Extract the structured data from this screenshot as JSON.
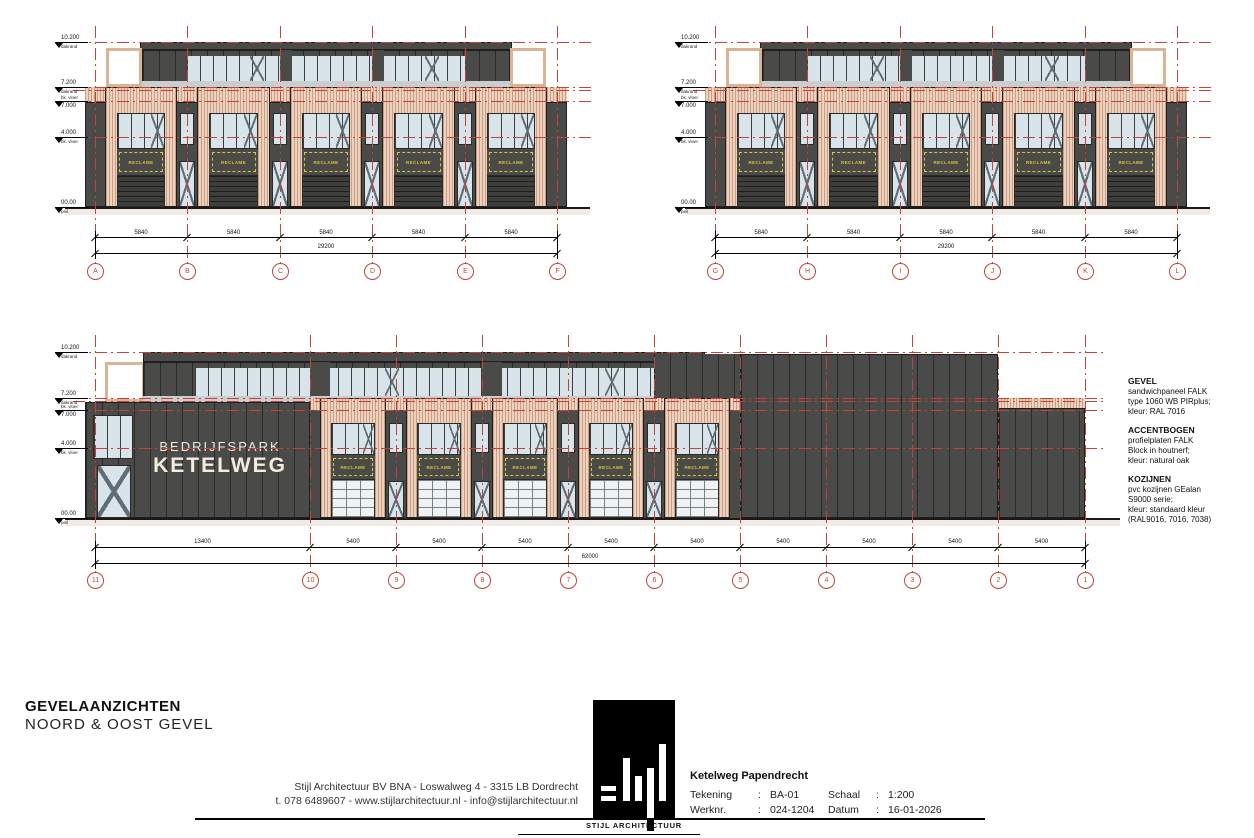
{
  "reclame_label": "RECLAME",
  "levels": [
    {
      "value": "10.200",
      "sub": "dakrand"
    },
    {
      "value": "7.200",
      "sub": "dakrand"
    },
    {
      "value": "7.000",
      "sub": "bk. vloer"
    },
    {
      "value": "4.000",
      "sub": "bk. vloer"
    },
    {
      "value": "00.00",
      "sub": "peil"
    }
  ],
  "elevations": {
    "top_left": {
      "grids": [
        "A",
        "B",
        "C",
        "D",
        "E",
        "F"
      ],
      "bay_dims": [
        "5840",
        "5840",
        "5840",
        "5840",
        "5840"
      ],
      "total_dim": "29200"
    },
    "top_right": {
      "grids": [
        "G",
        "H",
        "I",
        "J",
        "K",
        "L"
      ],
      "bay_dims": [
        "5840",
        "5840",
        "5840",
        "5840",
        "5840"
      ],
      "total_dim": "29200"
    },
    "bottom": {
      "grids": [
        "11",
        "10",
        "9",
        "8",
        "7",
        "6",
        "5",
        "4",
        "3",
        "2",
        "1"
      ],
      "bay_dims": [
        "13400",
        "5400",
        "5400",
        "5400",
        "5400",
        "5400",
        "5400",
        "5400",
        "5400",
        "5400"
      ],
      "total_dim": "62000",
      "sign_line1": "BEDRIJFSPARK",
      "sign_line2": "KETELWEG"
    }
  },
  "specs": [
    {
      "title": "GEVEL",
      "lines": [
        "sandwichpaneel FALK",
        "type 1060 WB PIRplus;",
        "kleur: RAL 7016"
      ]
    },
    {
      "title": "ACCENTBOGEN",
      "lines": [
        "profielplaten FALK",
        "Block in houtnerf;",
        "kleur: natural oak"
      ]
    },
    {
      "title": "KOZIJNEN",
      "lines": [
        "pvc kozijnen GEalan",
        "S9000 serie;",
        "kleur: standaard kleur",
        "(RAL9016, 7016, 7038)"
      ]
    }
  ],
  "footer": {
    "title_line1": "GEVELAANZICHTEN",
    "title_line2": "NOORD & OOST GEVEL",
    "address_line1": "Stijl Architectuur BV BNA   -   Loswalweg 4   -   3315 LB Dordrecht",
    "address_line2": "t. 078 6489607   -   www.stijlarchitectuur.nl   -   info@stijlarchitectuur.nl",
    "logo_text": "STIJL ARCHITECTUUR",
    "project": "Ketelweg Papendrecht",
    "colon": ":",
    "fields": [
      {
        "label": "Tekening",
        "value": "BA-01"
      },
      {
        "label": "Werknr.",
        "value": "024-1204"
      },
      {
        "label": "Schaal",
        "value": "1:200"
      },
      {
        "label": "Datum",
        "value": "16-01-2026"
      }
    ]
  },
  "colors": {
    "grid_red": "#c04437",
    "reclame_yellow": "#dbc634",
    "facade_dark": "#4a4a49",
    "accent_wood": "#ecd2bf",
    "glass": "#d9e4ea",
    "sign_text": "#f3ecdf"
  }
}
